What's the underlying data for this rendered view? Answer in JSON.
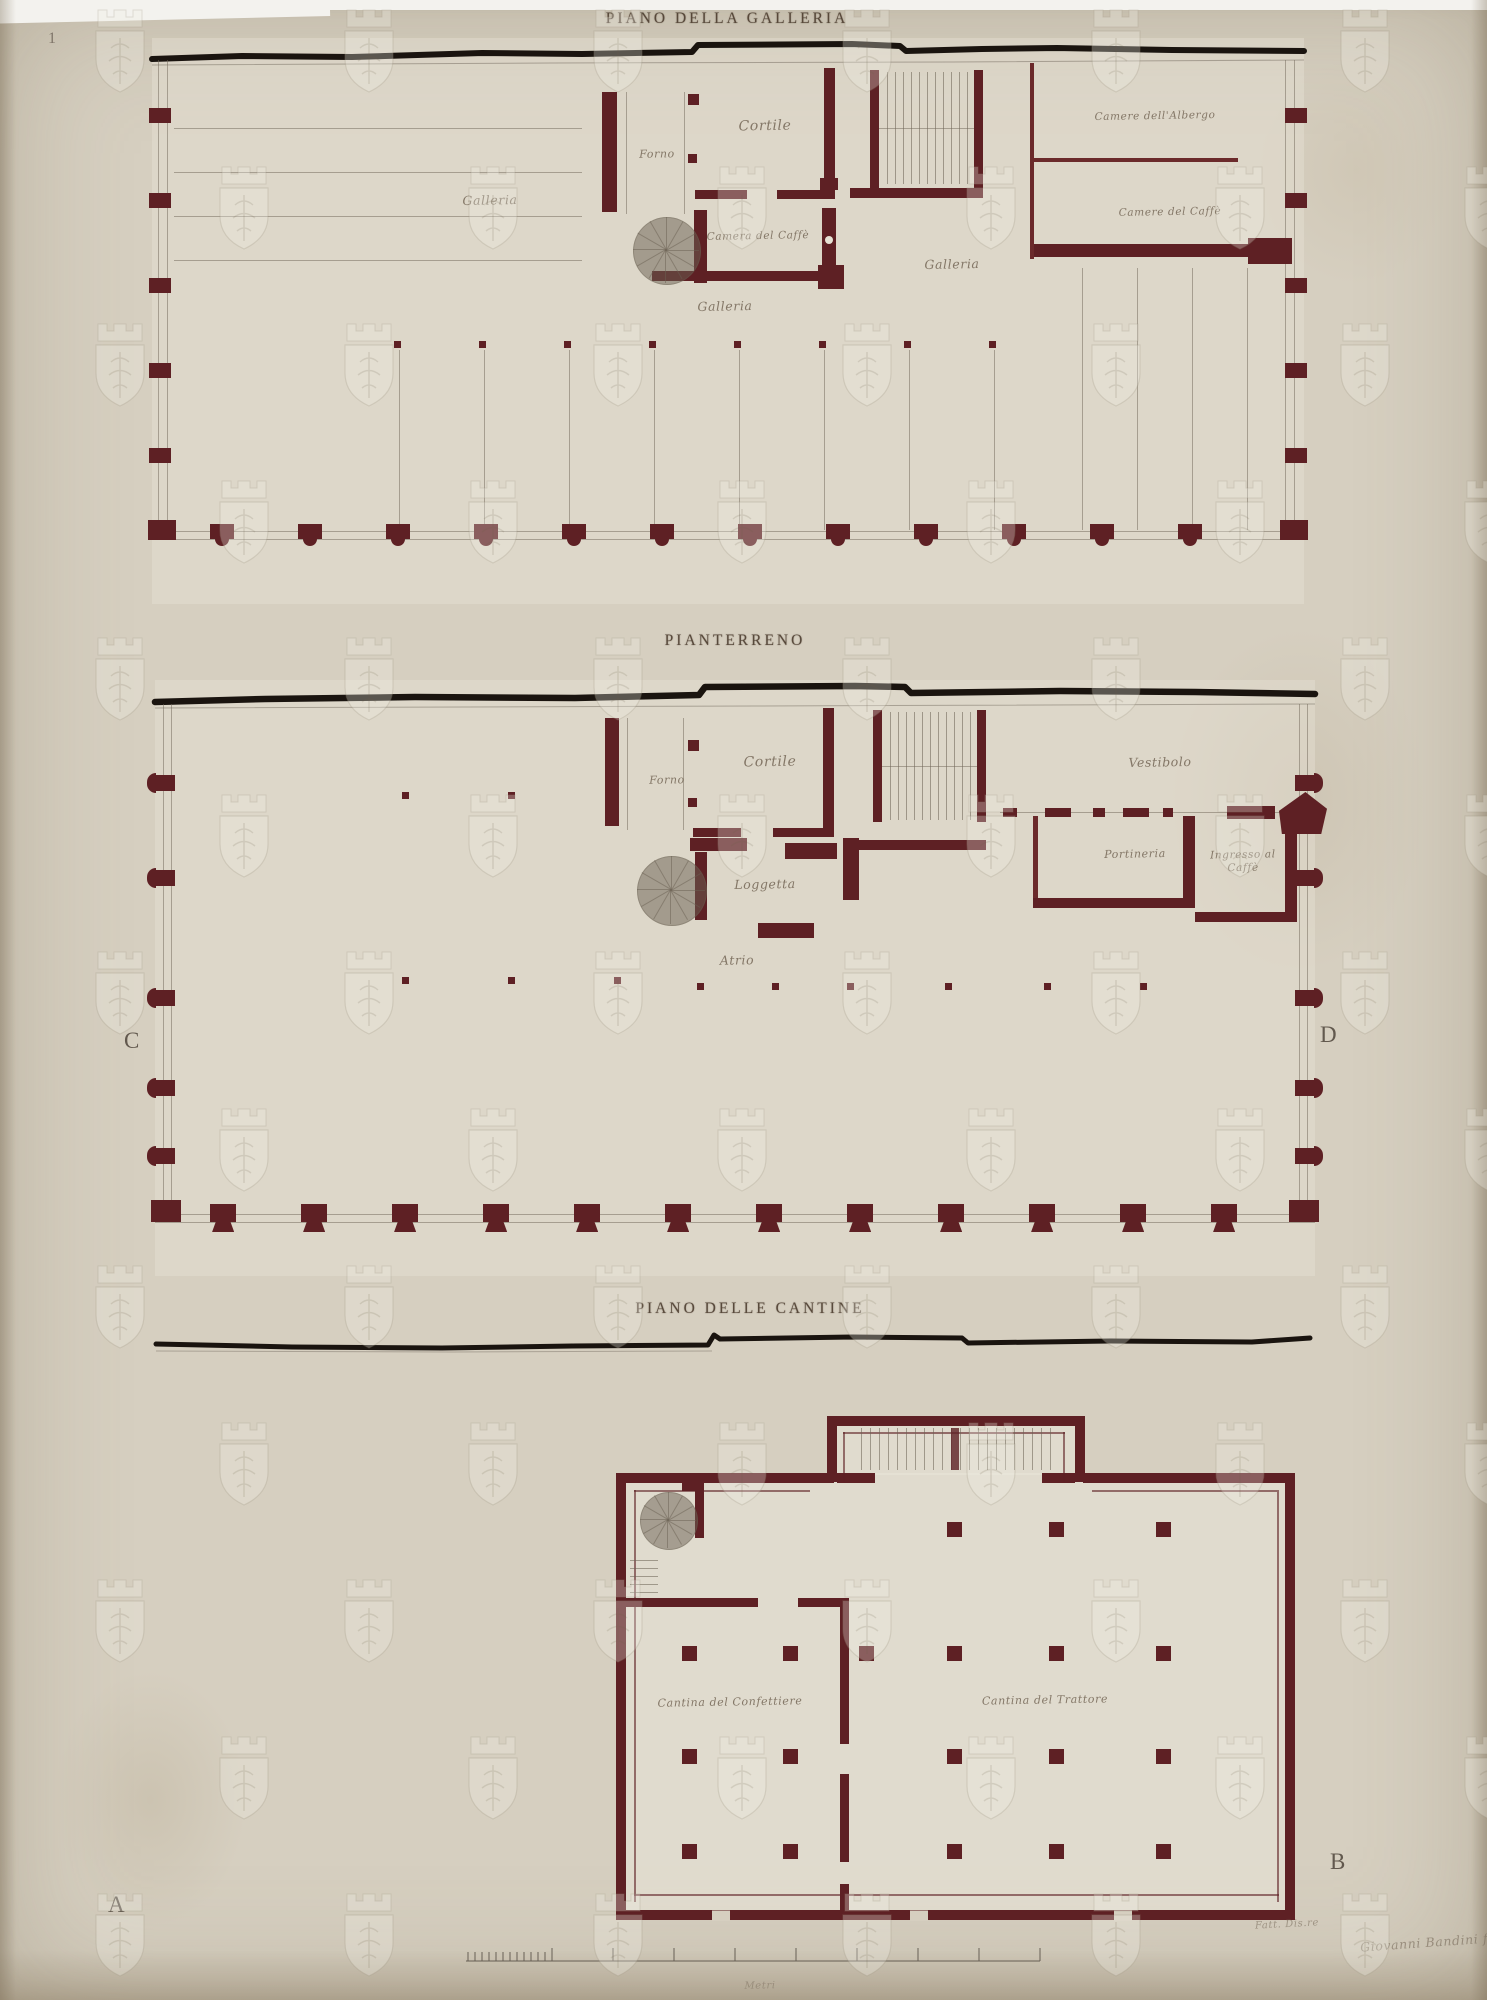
{
  "plans": {
    "galleria": {
      "title": "PIANO DELLA GALLERIA",
      "labels": {
        "galleria_left": "Galleria",
        "forno": "Forno",
        "cortile": "Cortile",
        "camera_caffe": "Camera del Caffè",
        "galleria_center": "Galleria",
        "galleria_right": "Galleria",
        "camere_albergo": "Camere dell'Albergo",
        "camere_caffe": "Camere del Caffè"
      }
    },
    "pianterreno": {
      "title": "PIANTERRENO",
      "labels": {
        "forno": "Forno",
        "cortile": "Cortile",
        "loggetta": "Loggetta",
        "atrio": "Atrio",
        "vestibolo": "Vestibolo",
        "portineria": "Portineria",
        "ingresso_caffe": "Ingresso al Caffè"
      }
    },
    "cantine": {
      "title": "PIANO DELLE CANTINE",
      "labels": {
        "confettiere": "Cantina del Confettiere",
        "trattore": "Cantina del Trattore"
      }
    }
  },
  "markers": {
    "plate": "1",
    "c": "C",
    "d": "D",
    "a": "A",
    "b": "B"
  },
  "footer": {
    "scale_label": "Metri",
    "signature_note": "Fatt. Dis.re",
    "signature_name": "Giovanni Bandini f."
  },
  "colors": {
    "wall": "#5e2024",
    "ink": "#1a140f",
    "paper": "#d6cfc0"
  }
}
